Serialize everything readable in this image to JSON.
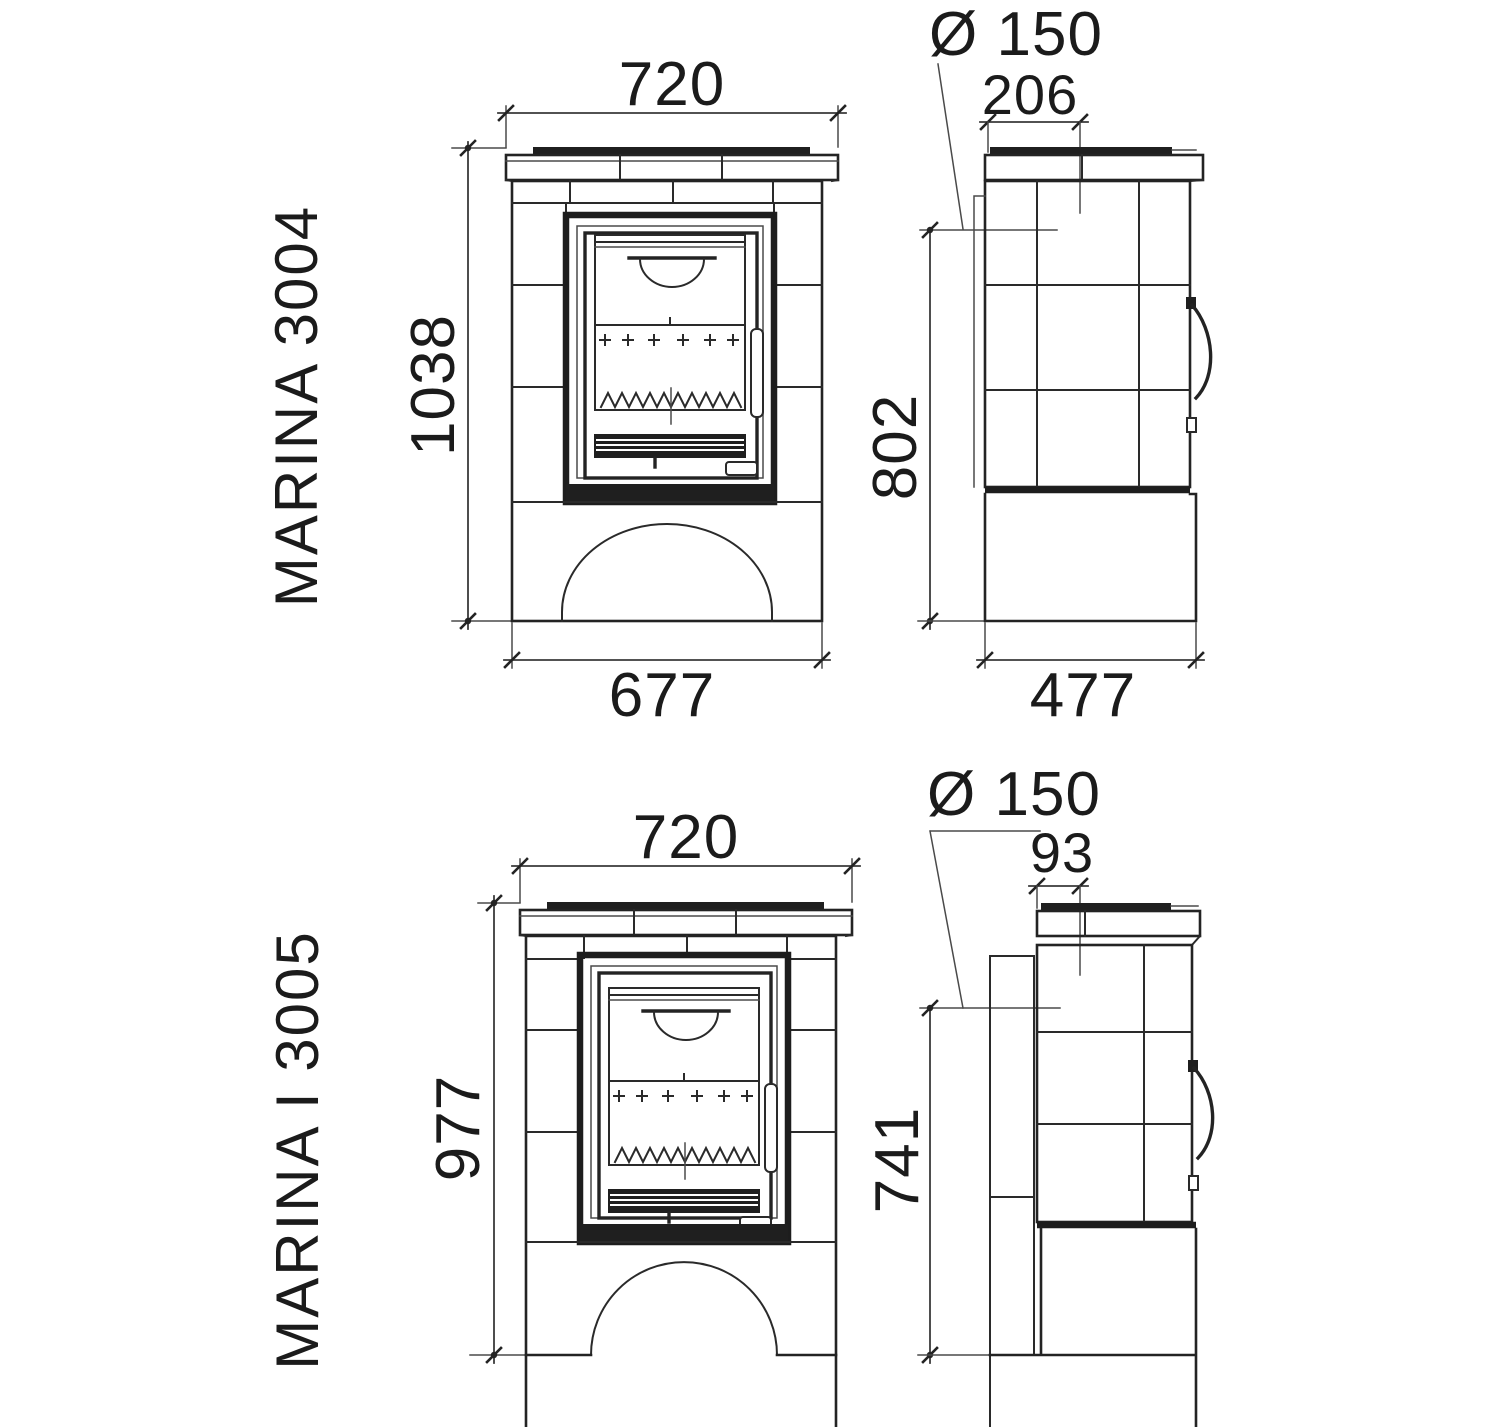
{
  "drawing": {
    "kind": "stove-dimension-diagram",
    "background_color": "#ffffff",
    "line_color": "#232323",
    "views": [
      "front",
      "side"
    ]
  },
  "models": [
    {
      "name": "MARINA 3004",
      "front": {
        "top_width": "720",
        "height": "1038",
        "base_width": "677"
      },
      "side": {
        "flue_diameter": "Ø 150",
        "flue_center_offset": "206",
        "rear_outlet_height": "802",
        "depth": "477"
      }
    },
    {
      "name": "MARINA I 3005",
      "front": {
        "top_width": "720",
        "height": "977"
      },
      "side": {
        "flue_diameter": "Ø 150",
        "flue_center_offset": "93",
        "rear_outlet_height": "741"
      }
    }
  ]
}
